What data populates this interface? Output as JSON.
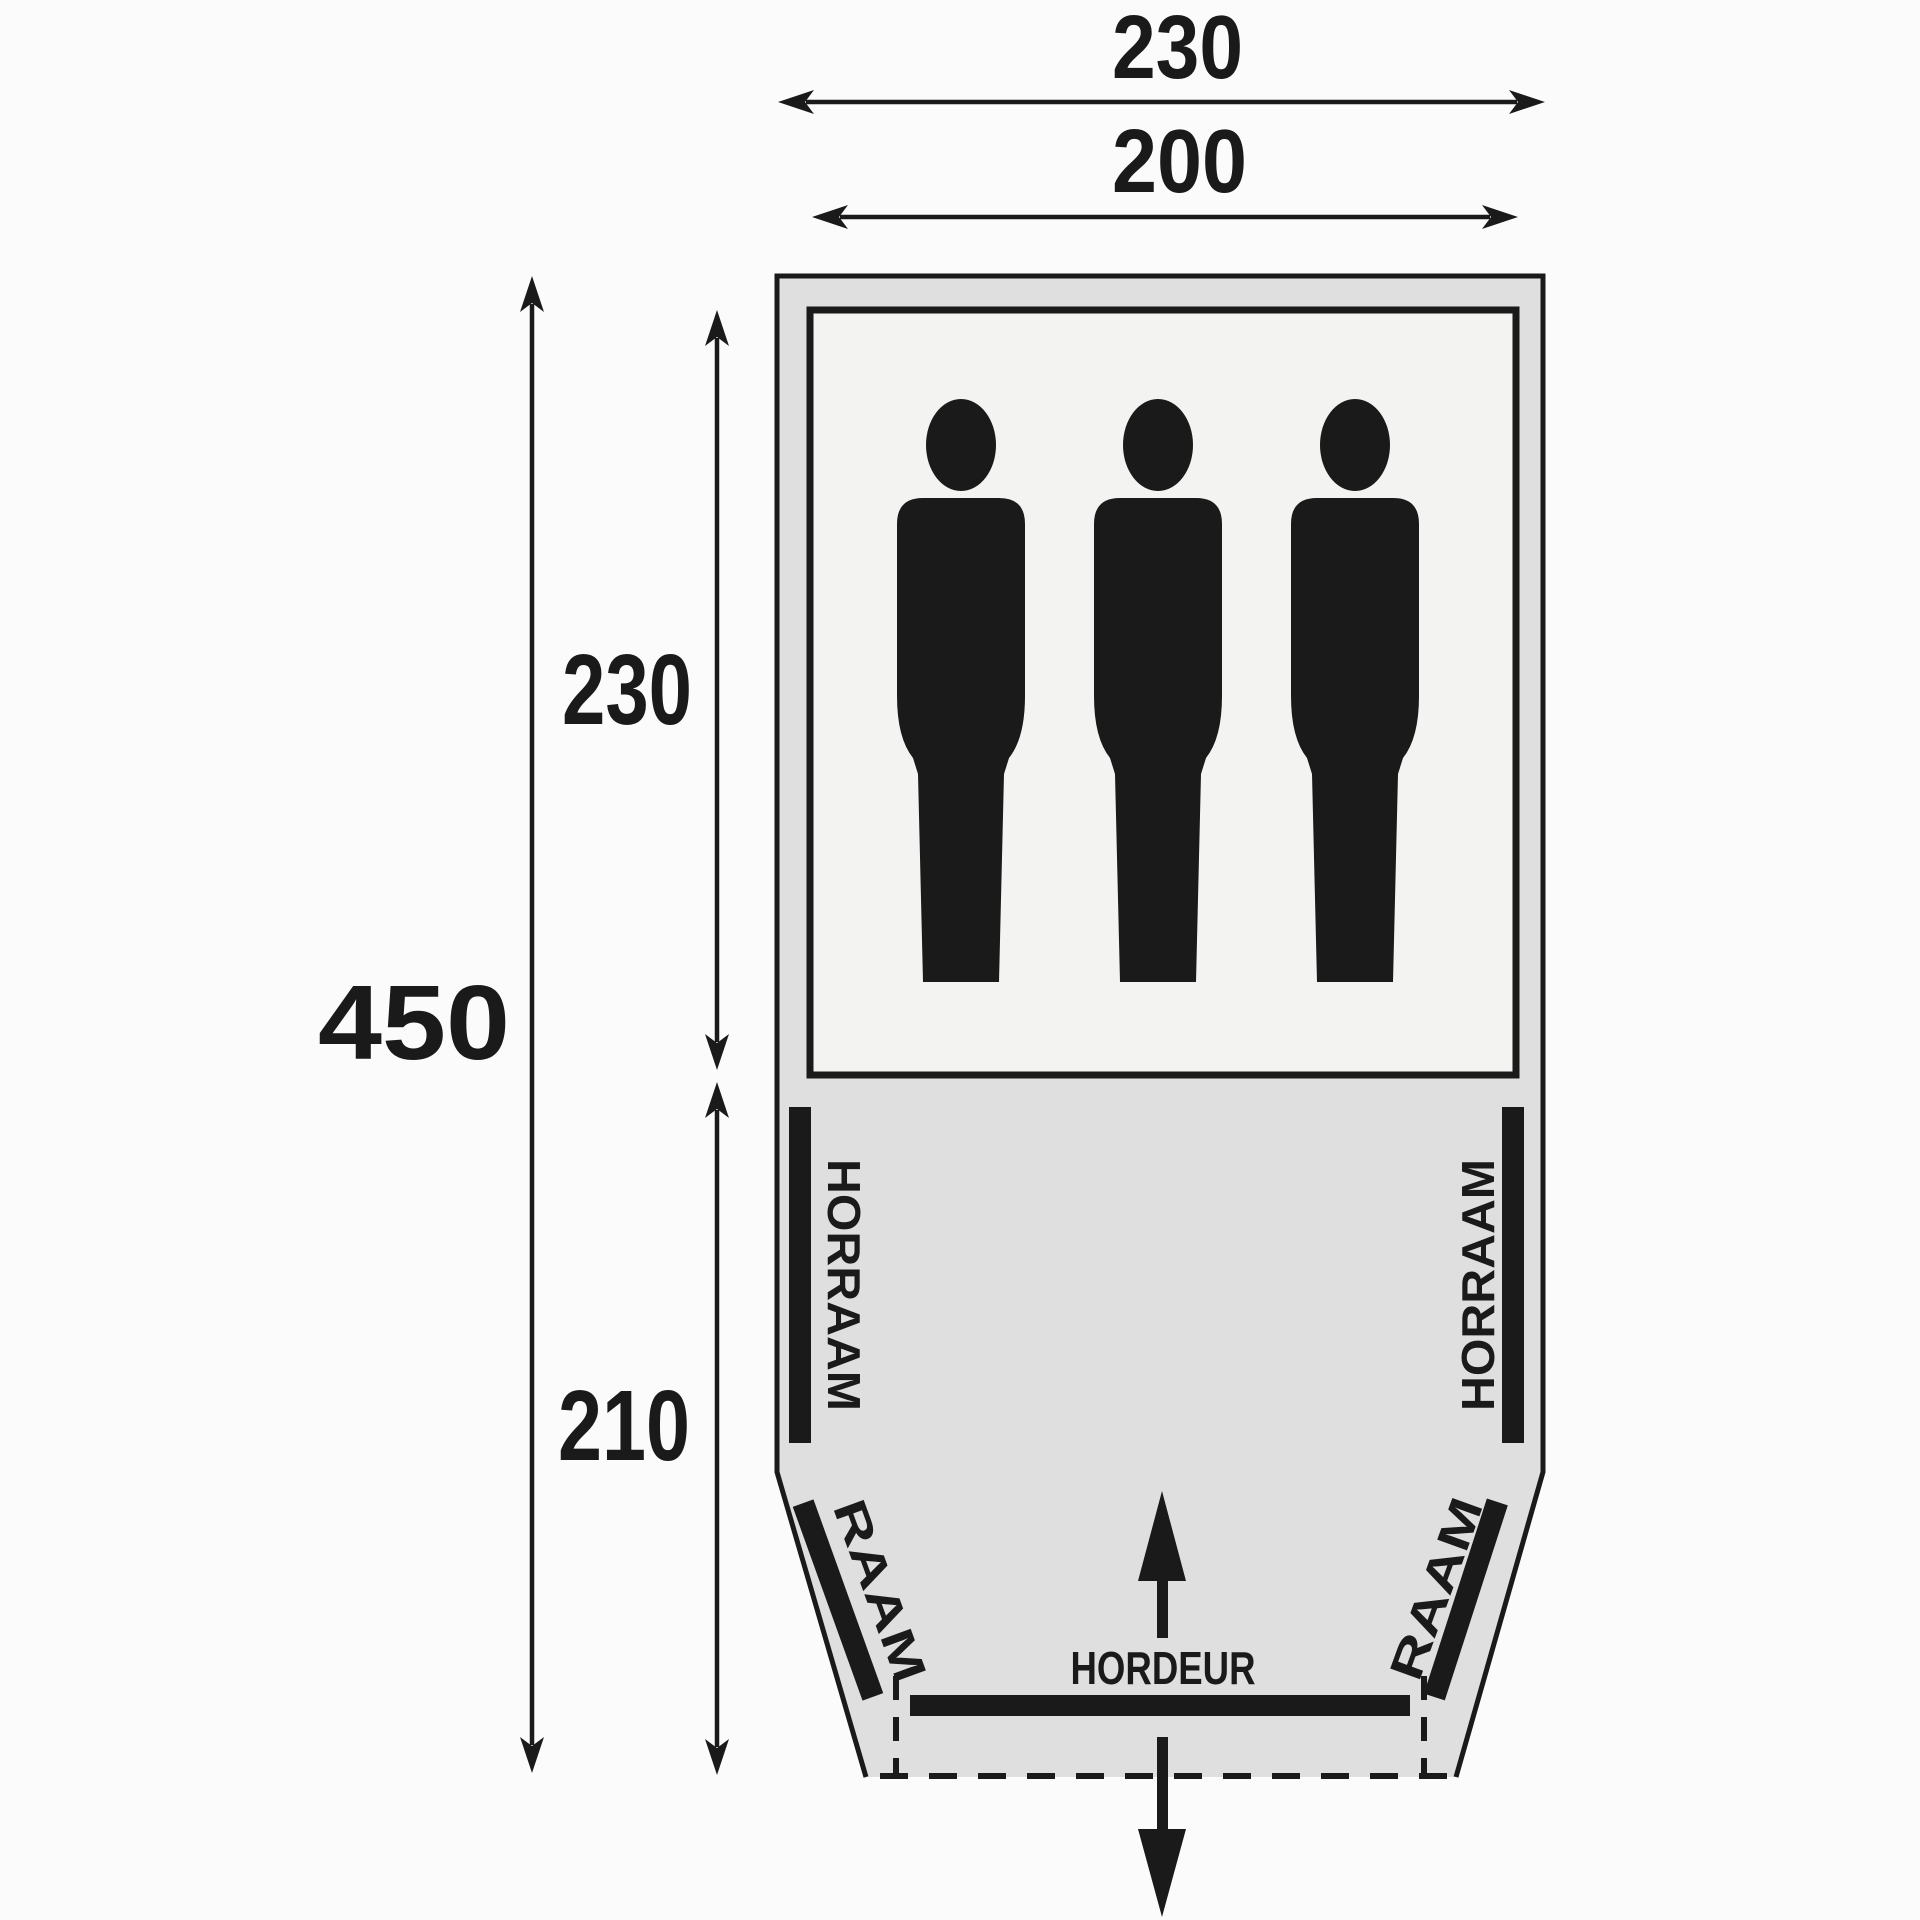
{
  "diagram": {
    "dim_outer_width": "230",
    "dim_inner_width": "200",
    "dim_total_length": "450",
    "dim_cabin_length": "230",
    "dim_porch_length": "210",
    "label_mesh_window_left": "HORRAAM",
    "label_mesh_window_right": "HORRAAM",
    "label_window_left": "RAAM",
    "label_window_right": "RAAM",
    "label_mesh_door": "HORDEUR",
    "persons": 3,
    "colors": {
      "ink": "#1a1a1a",
      "tent_fill": "#dfdfdf",
      "cabin_fill": "#f3f3f2",
      "background": "#fbfbfb"
    }
  }
}
